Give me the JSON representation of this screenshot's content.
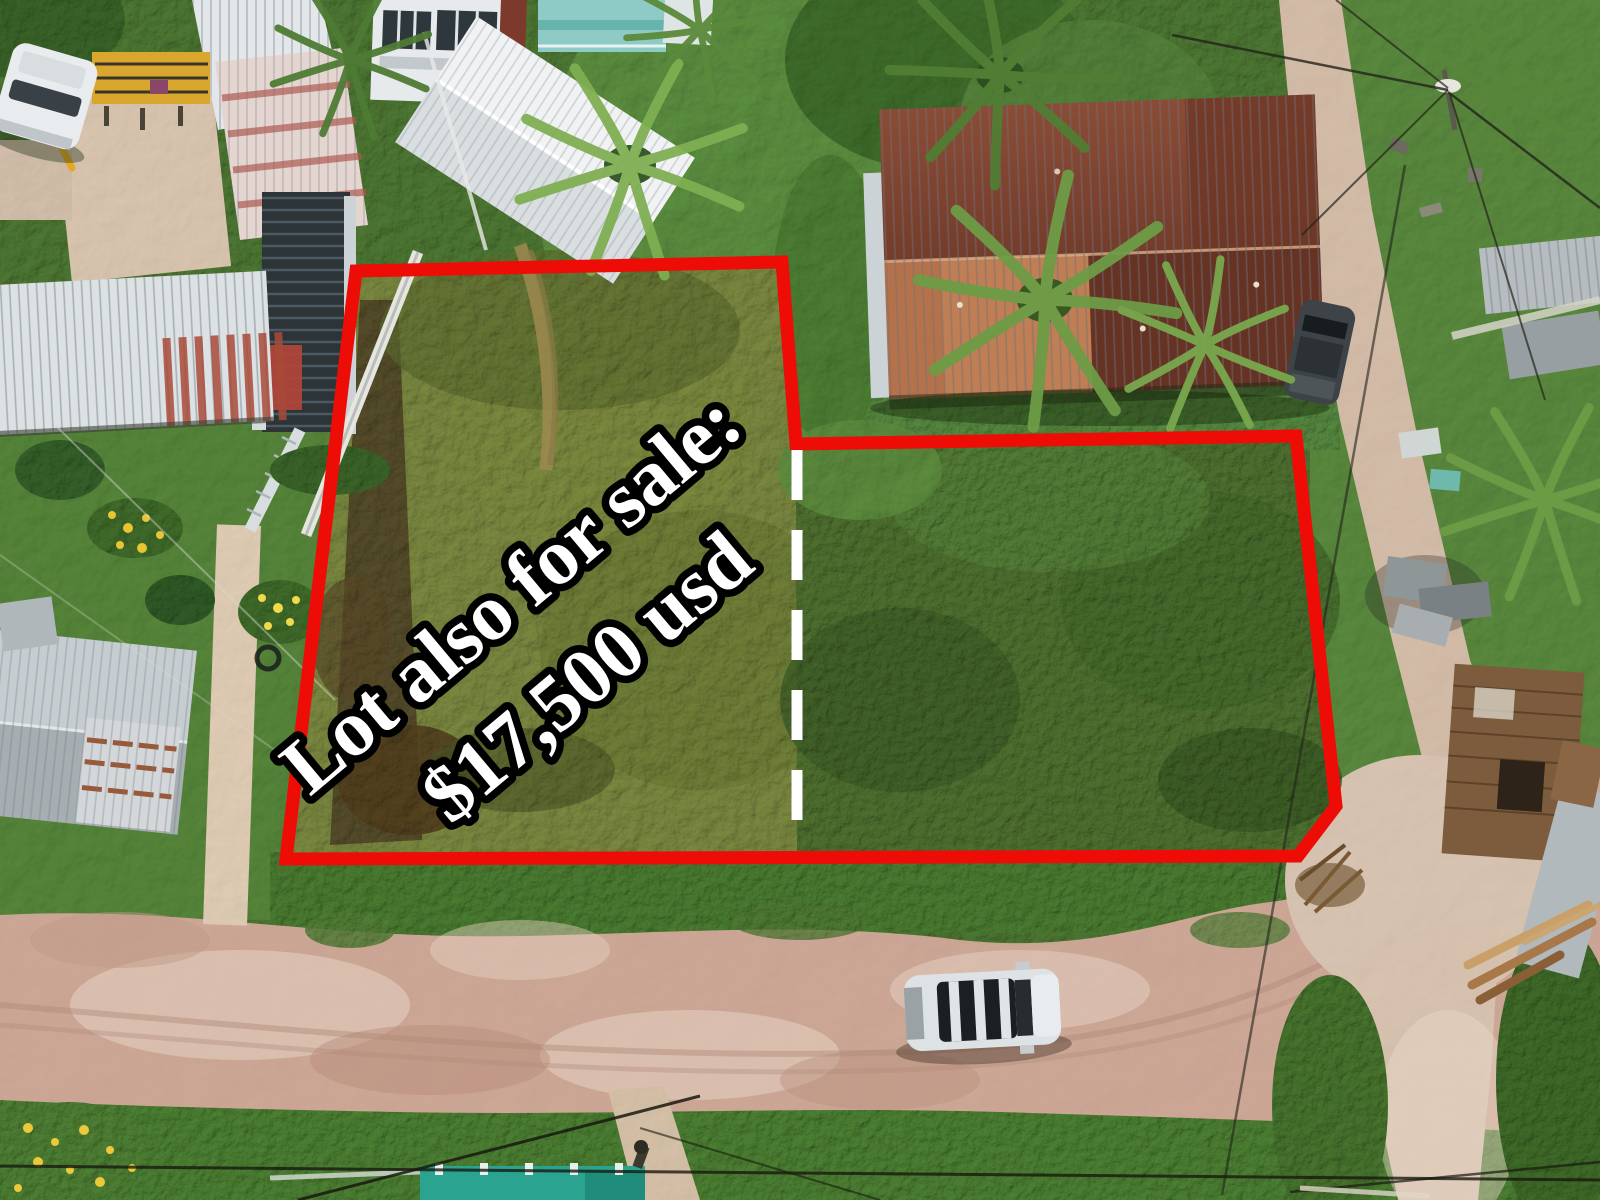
{
  "overlay": {
    "sale_text_line1": "Lot also for sale:",
    "sale_text_line2": "$17,500 usd"
  },
  "annotation_colors": {
    "lot_boundary": "#ee0d06",
    "lot_divider": "#ffffff",
    "text_fill": "#ffffff",
    "text_outline": "#000000"
  },
  "scene_objects": [
    "overgrown-lot-left",
    "overgrown-lot-right",
    "white-dashed-lot-divider",
    "rusty-corrugated-roof-house",
    "white-metal-roof-houses",
    "teal-roof-house",
    "dark-slatted-building",
    "palm-trees",
    "white-suv-on-dirt-road",
    "dark-parked-car",
    "white-van",
    "yellow-scaffold",
    "dirt-road-bottom",
    "dirt-road-right",
    "sand-footpath",
    "power-lines-and-pole",
    "teal-fence",
    "lumber-pile",
    "yellow-flower-bushes",
    "lawn-garden"
  ]
}
